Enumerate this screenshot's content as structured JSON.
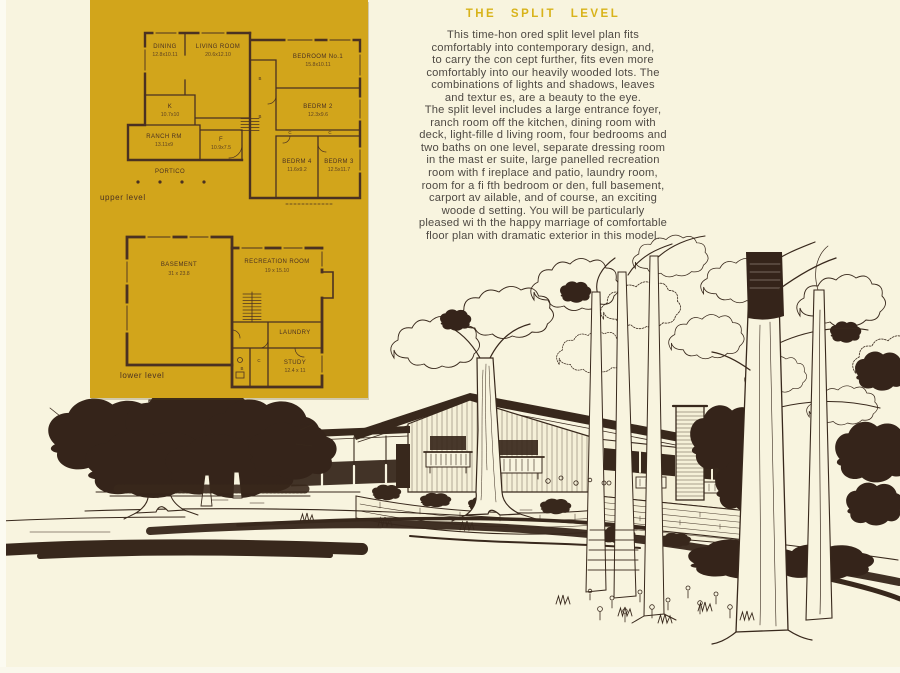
{
  "page": {
    "background": "#f8f4df",
    "edge_color": "#fcfbf1"
  },
  "plan_panel": {
    "background": "#d2a51b",
    "ink": "#4a3122",
    "upper_level_label": "upper level",
    "lower_level_label": "lower level",
    "upper": {
      "dining": {
        "name": "DINING",
        "dims": "12.8x10.11"
      },
      "living": {
        "name": "LIVING ROOM",
        "dims": "20.6x12.10"
      },
      "bedroom1": {
        "name": "BEDROOM No.1",
        "dims": "15.8x10.11"
      },
      "bedrm2": {
        "name": "BEDRM 2",
        "dims": "12.3x9.6"
      },
      "kitchen": {
        "name": "K",
        "dims": "10.7x10"
      },
      "ranch": {
        "name": "RANCH RM",
        "dims": "13.11x9"
      },
      "foyer": {
        "name": "F",
        "dims": "10.9x7.5"
      },
      "bedrm4": {
        "name": "BEDRM 4",
        "dims": "11.6x9.2"
      },
      "bedrm3": {
        "name": "BEDRM 3",
        "dims": "12.5x11.7"
      },
      "portico": {
        "name": "PORTICO"
      },
      "closet": "C",
      "bath": "B"
    },
    "lower": {
      "basement": {
        "name": "BASEMENT",
        "dims": "31 x 23.8"
      },
      "recreation": {
        "name": "RECREATION ROOM",
        "dims": "19 x 15.10"
      },
      "laundry": {
        "name": "LAUNDRY"
      },
      "study": {
        "name": "STUDY",
        "dims": "12.4 x 11"
      },
      "closet": "C",
      "bath": "B"
    }
  },
  "article": {
    "title": "THE SPLIT LEVEL",
    "title_color": "#d8b31a",
    "body_color": "#4e4943",
    "lines": [
      "This time-hon ored split level plan fits",
      "comfortably into  contemporary design, and,",
      "to carry the con cept further, fits even more",
      "comfortably into  our heavily wooded lots.  The",
      "combinations  of lights and shadows, leaves",
      "and textur es, are a beauty to the eye.",
      "The split level  includes a large entrance foyer,",
      "ranch room off  the kitchen, dining room with",
      "deck, light-fille d living room, four bedrooms and",
      "two baths on  one level, separate dressing room",
      "in the mast er suite, large panelled recreation",
      "room with f ireplace and patio, laundry room,",
      "room for a fi fth bedroom or den, full basement,",
      "carport av ailable, and of course, an exciting",
      "woode d setting.  You will be particularly",
      "pleased wi th the happy marriage of comfortable",
      "floor plan  with dramatic exterior in this model."
    ]
  },
  "illustration": {
    "ink": "#38281c",
    "description": "Pen-and-ink rendering of the split level house among tall wooded trees"
  }
}
